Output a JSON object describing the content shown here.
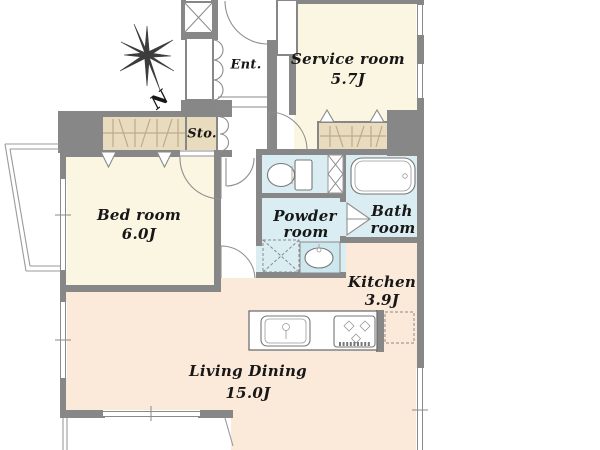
{
  "title": "Apartment floor plan",
  "colors": {
    "wall": "#878787",
    "room": "#faf6e2",
    "living": "#fbe9da",
    "wet": "#d9edf2",
    "closet": "#e9dcbe"
  },
  "compass": {
    "north_label": "N"
  },
  "rooms": {
    "entrance": {
      "label": "Ent."
    },
    "service": {
      "label": "Service room",
      "size": "5.7J"
    },
    "storage": {
      "label": "Sto."
    },
    "bedroom": {
      "label": "Bed room",
      "size": "6.0J"
    },
    "powder": {
      "label": "Powder room",
      "label_lines": [
        "Powder",
        "room"
      ]
    },
    "bath": {
      "label": "Bath room",
      "label_lines": [
        "Bath",
        "room"
      ]
    },
    "kitchen": {
      "label": "Kitchen",
      "size": "3.9J"
    },
    "living_dining": {
      "label": "Living Dining",
      "size": "15.0J"
    }
  },
  "fixtures": {
    "bathtub": "bathtub-icon",
    "toilet": "toilet-icon",
    "washbasin": "washbasin-icon",
    "washing_machine_space": "washing-machine-space-icon",
    "kitchen_sink": "kitchen-sink-icon",
    "gas_stove": "gas-stove-icon",
    "refrigerator_space": "refrigerator-space-icon",
    "closet": "closet-hatch-icon",
    "pipe_space": "pipe-space-icon"
  }
}
